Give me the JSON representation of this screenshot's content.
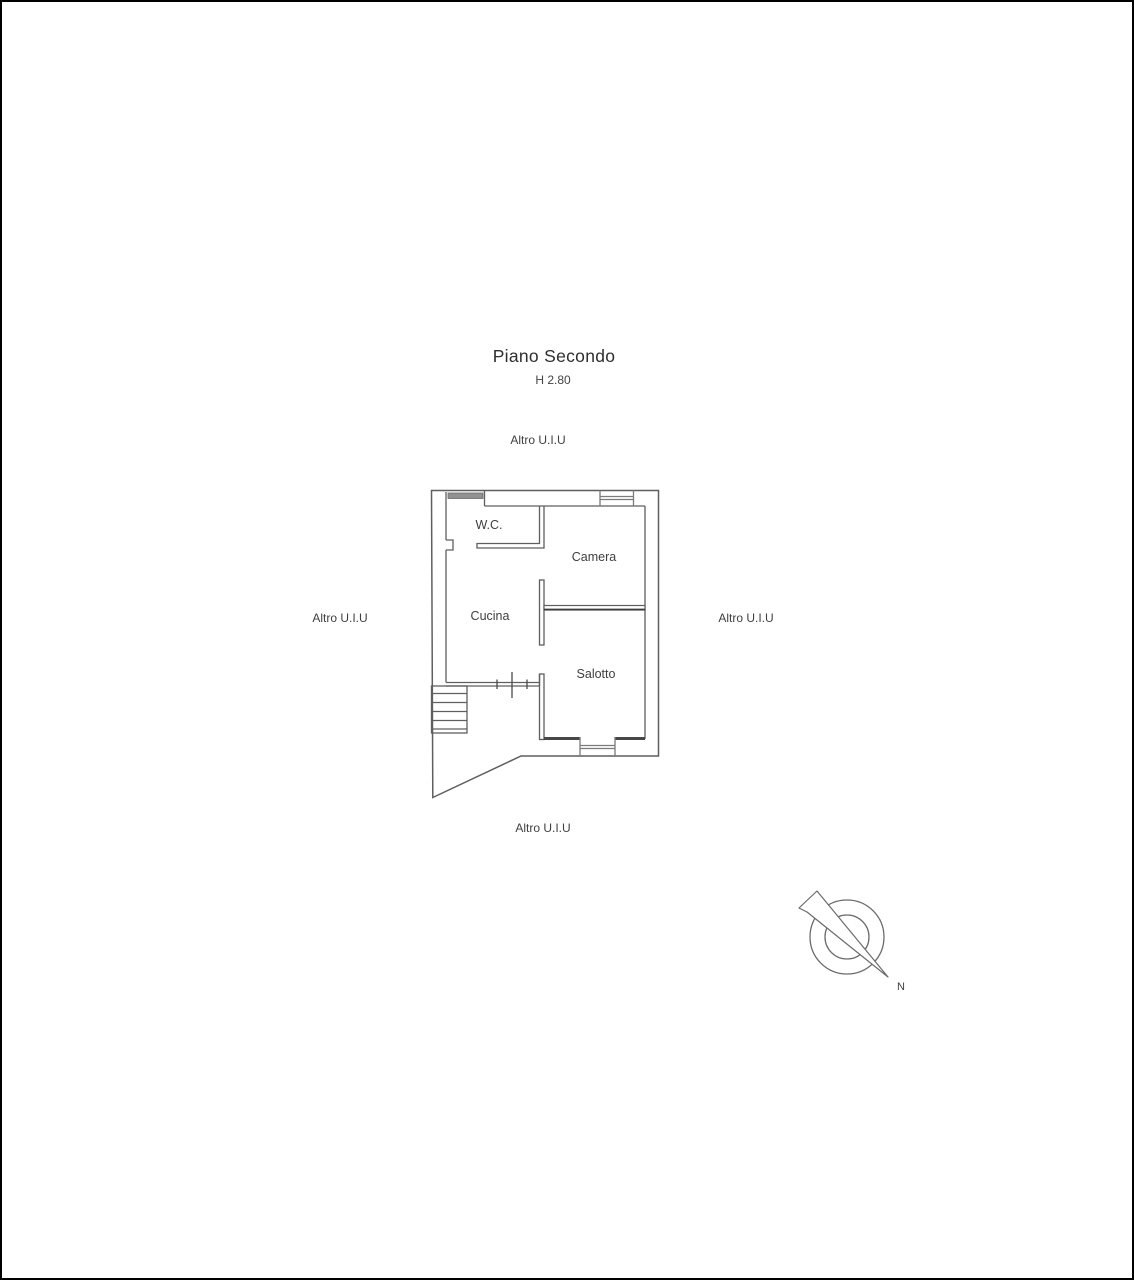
{
  "page": {
    "background": "#ffffff",
    "border_color": "#000000"
  },
  "header": {
    "title": "Piano Secondo",
    "ceiling_height": "H 2.80"
  },
  "floor_plan": {
    "rooms": {
      "wc": "W.C.",
      "camera": "Camera",
      "cucina": "Cucina",
      "salotto": "Salotto"
    },
    "adjacent_units": {
      "top": "Altro U.I.U",
      "left": "Altro U.I.U",
      "right": "Altro U.I.U",
      "bottom": "Altro U.I.U"
    }
  },
  "compass": {
    "north_label": "N"
  },
  "colors": {
    "wall_line": "#5f5f5f",
    "dark_wall": "#3e3e3e",
    "window_line": "#7a7a7a",
    "hatch_fill": "#919191",
    "text": "#3d3d3d"
  }
}
